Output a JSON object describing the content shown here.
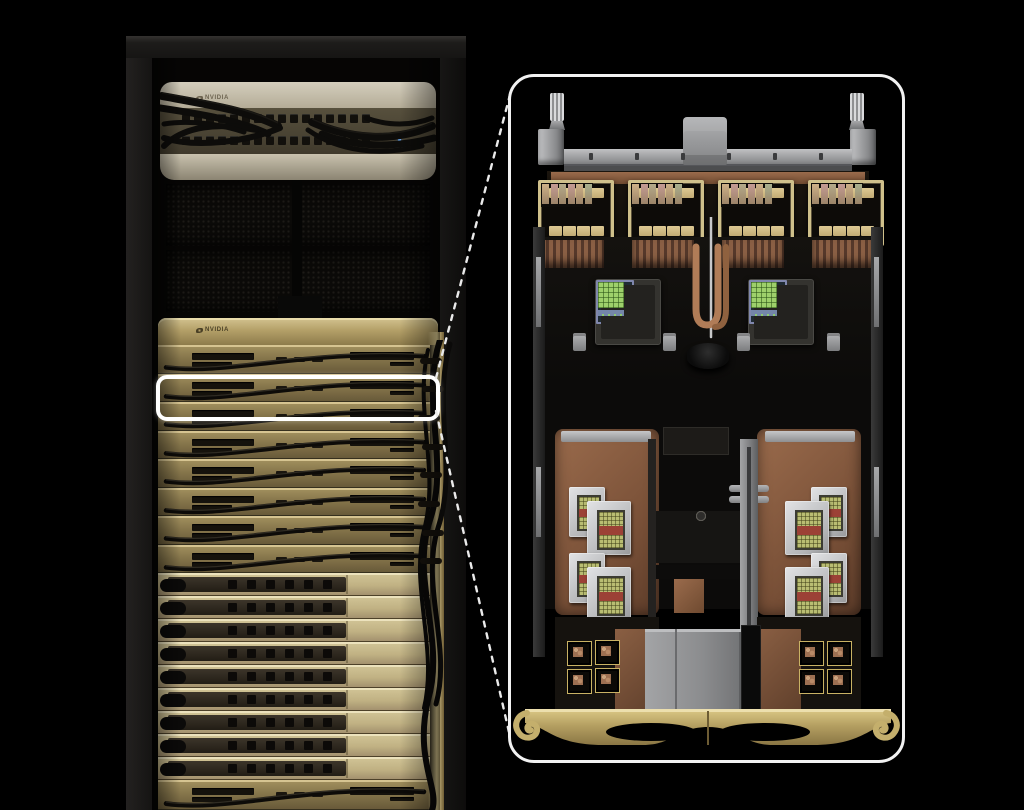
{
  "scene": {
    "type": "product-render",
    "description": "Black-background studio render of an NVIDIA AI server rack (gold compute and switch trays, draped black cables) with a white rounded highlight around one tray and a dashed-line callout to a large magnified top-down view of the liquid-cooled compute tray",
    "background_color": "#000000"
  },
  "palette": {
    "background": "#000000",
    "highlight_white": "#ffffff",
    "inset_border": "#f2f2f2",
    "chip_frame_gold": "#cfc08b",
    "cpu_chip_green": "#9ed06b",
    "cpu_chip_blue": "#7486a9",
    "nic_chip_olive": "#b9bd72",
    "nic_chip_red": "#9c4136",
    "led_blue": "#6db0ff",
    "gold_bright": "#d8c893",
    "gold_mid": "#a08c58",
    "pale_tray": "#cdc094",
    "copper": "#9a6b4c",
    "silver": "#b9babc",
    "cable_black": "#0c0b09"
  },
  "rack": {
    "switch_unit": {
      "brand_label": "NVIDIA",
      "port_rows": 2,
      "ports_per_row": 16,
      "led_count": 2
    },
    "vent_panel_count": 2,
    "gold_bezel": {
      "brand_label": "NVIDIA"
    },
    "compute_tray_count": 8,
    "switch_tray_count": 9,
    "bottom_tray_count": 1,
    "ports_per_switch_tray": 6
  },
  "callout": {
    "style": "dashed",
    "highlighted_tray_index": 2
  },
  "inset": {
    "lifting_post_count": 2,
    "gpu_package_count": 4,
    "gpu_pads_top": 4,
    "gpu_pads_bottom": 4,
    "gpu_die_columns": 6,
    "cpu_module_count": 2,
    "nic_modules_per_side": 4,
    "capacitor_grid": {
      "cols": 6,
      "rows": 4
    },
    "small_chips_per_side": 4,
    "handle_cutout_count": 2,
    "crossbar_notch_count": 6
  }
}
